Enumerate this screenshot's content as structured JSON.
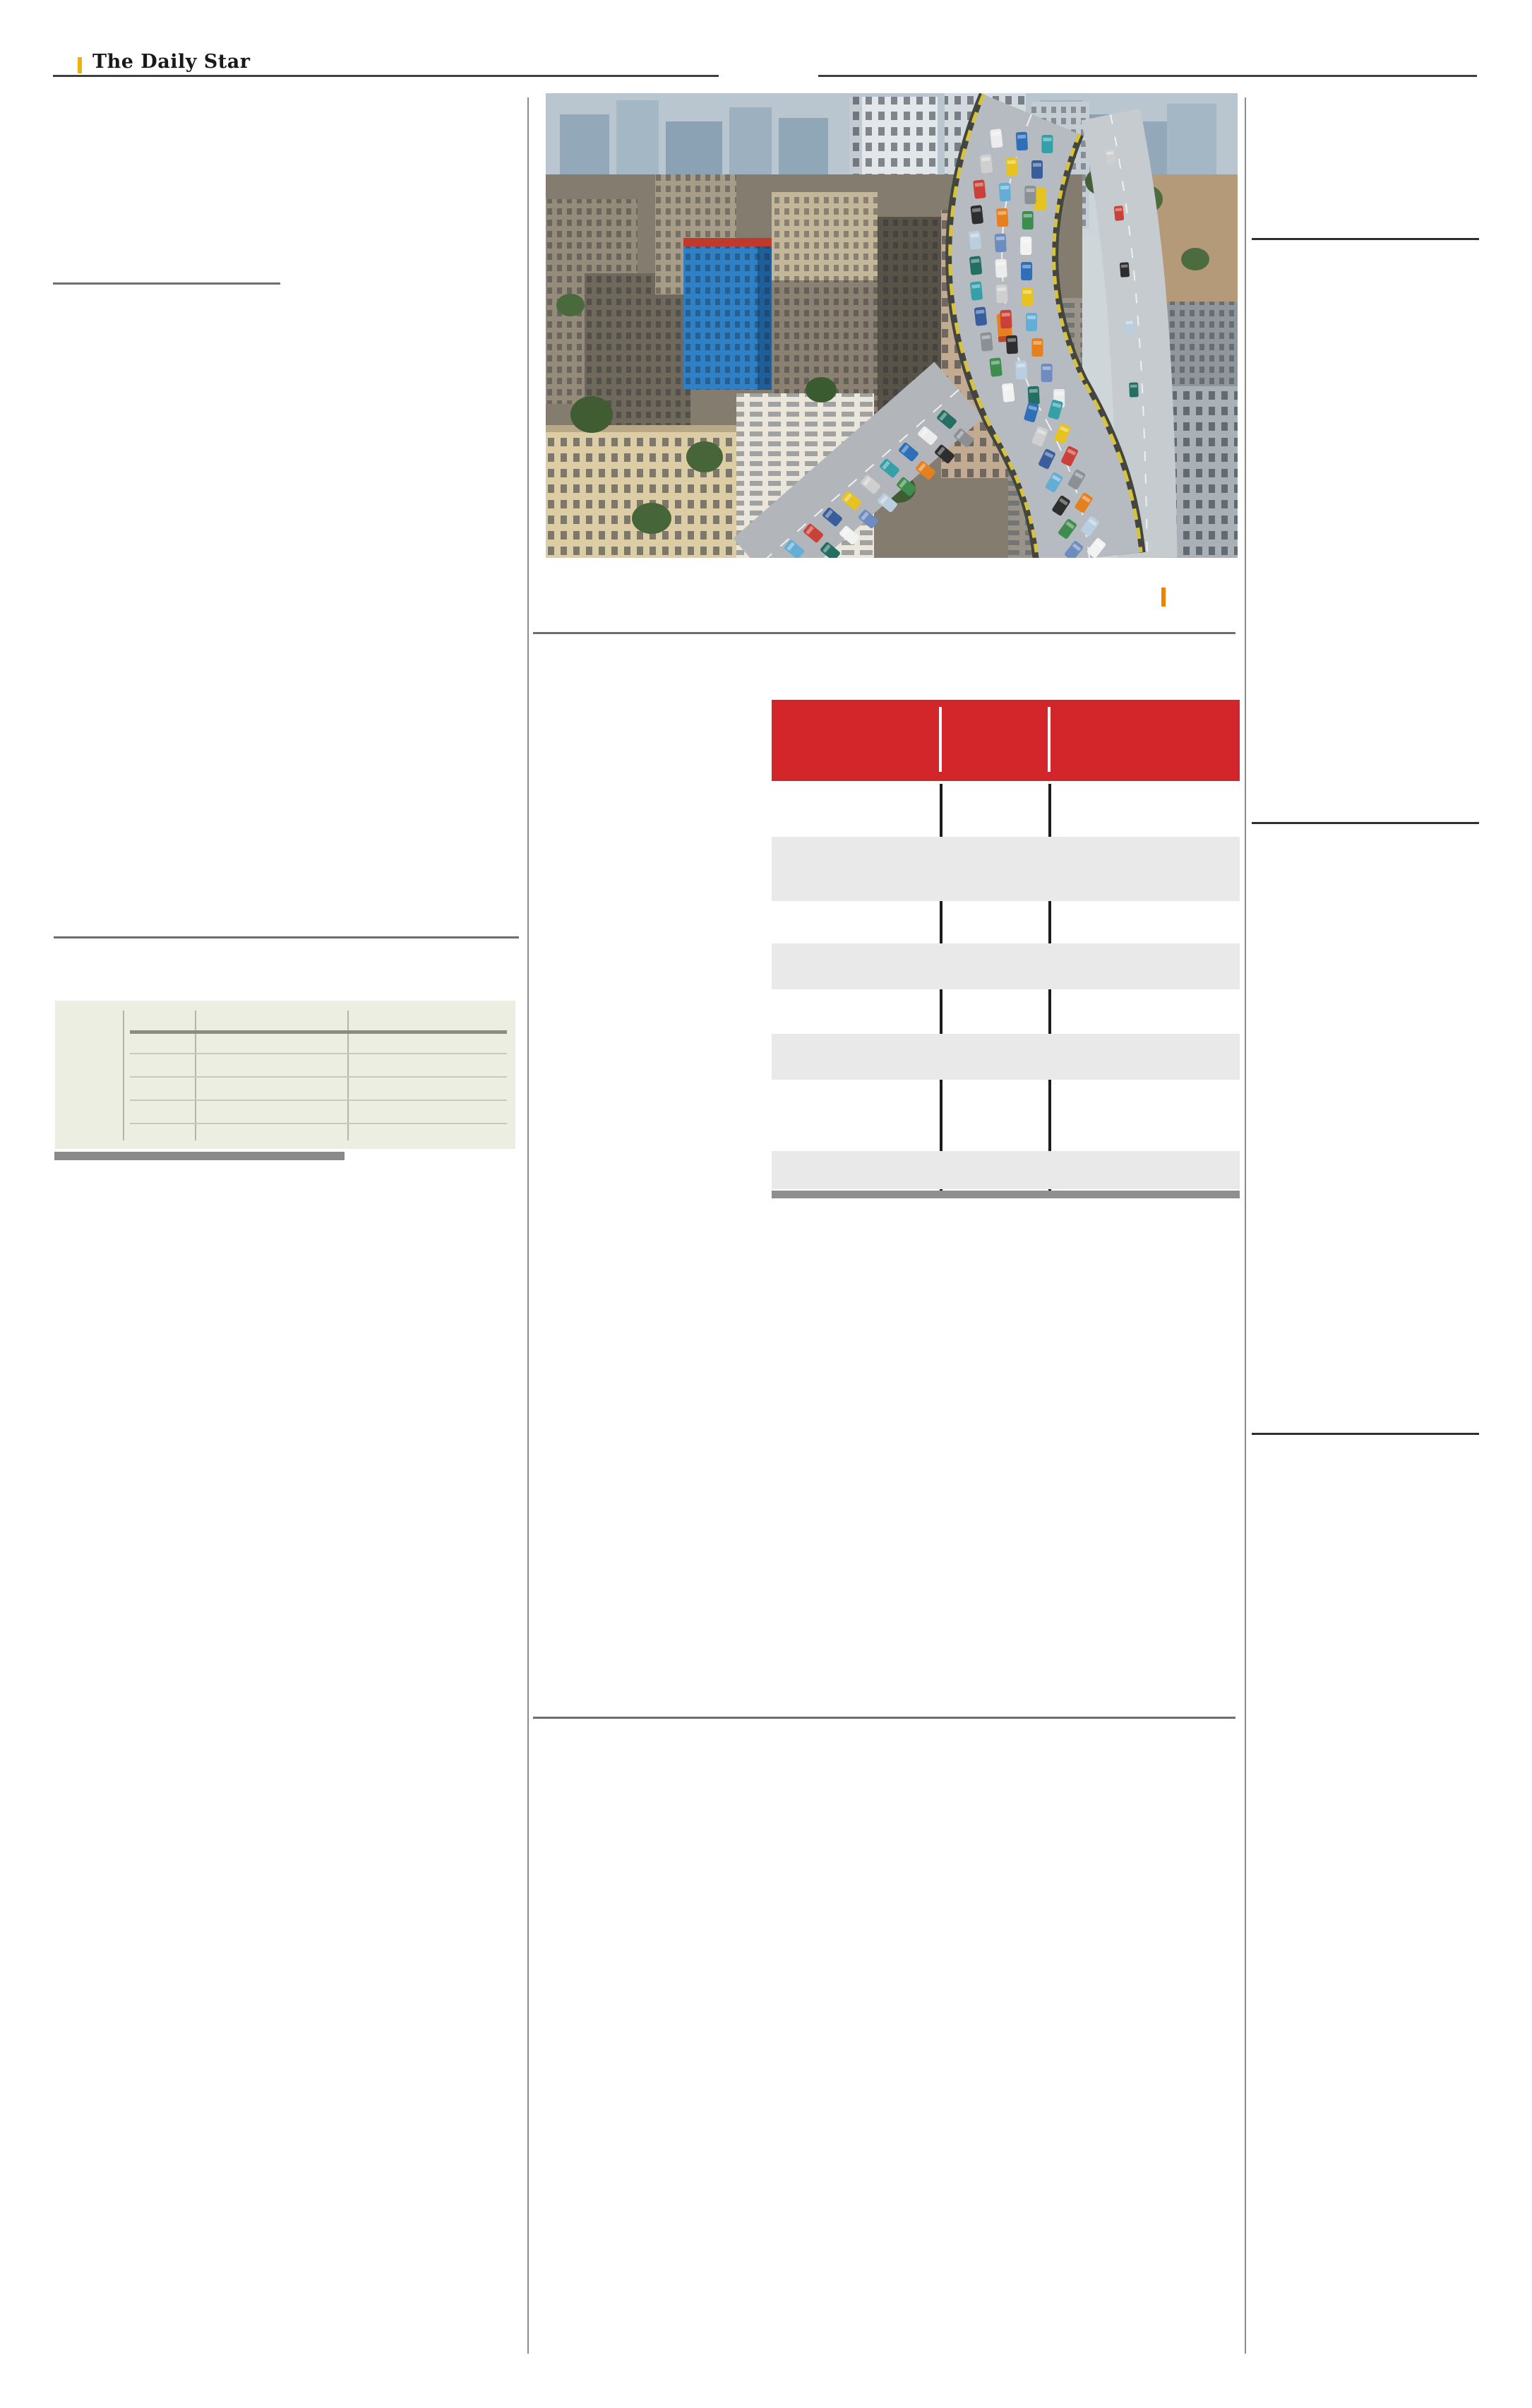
{
  "masthead": {
    "title": "The Daily Star"
  },
  "photo": {
    "name": "aerial-traffic-photo"
  },
  "colors": {
    "accent_red": "#d2262b",
    "masthead_yellow": "#e9b50b",
    "credit_orange": "#ef8200",
    "table_row_gray": "#e9e9e9",
    "table_line_black": "#1c1c1c",
    "table_footer_gray": "#8f8f8f",
    "left_table_bg": "#edeee2",
    "left_table_rule_dark": "#8b8e7e",
    "left_table_rule_light": "#c7cab9",
    "left_table_grid": "#b3b7a6",
    "page_rule_dark": "#3f3f3f",
    "page_rule_gray": "#6e6e6e",
    "column_separator_gray": "#8d8d8d",
    "left_bar_gray": "#8a8a8a"
  },
  "center_table": {
    "header_column_count": 3,
    "shaded_row_count": 4
  },
  "left_table": {
    "column_count": 4,
    "row_count": 5
  }
}
